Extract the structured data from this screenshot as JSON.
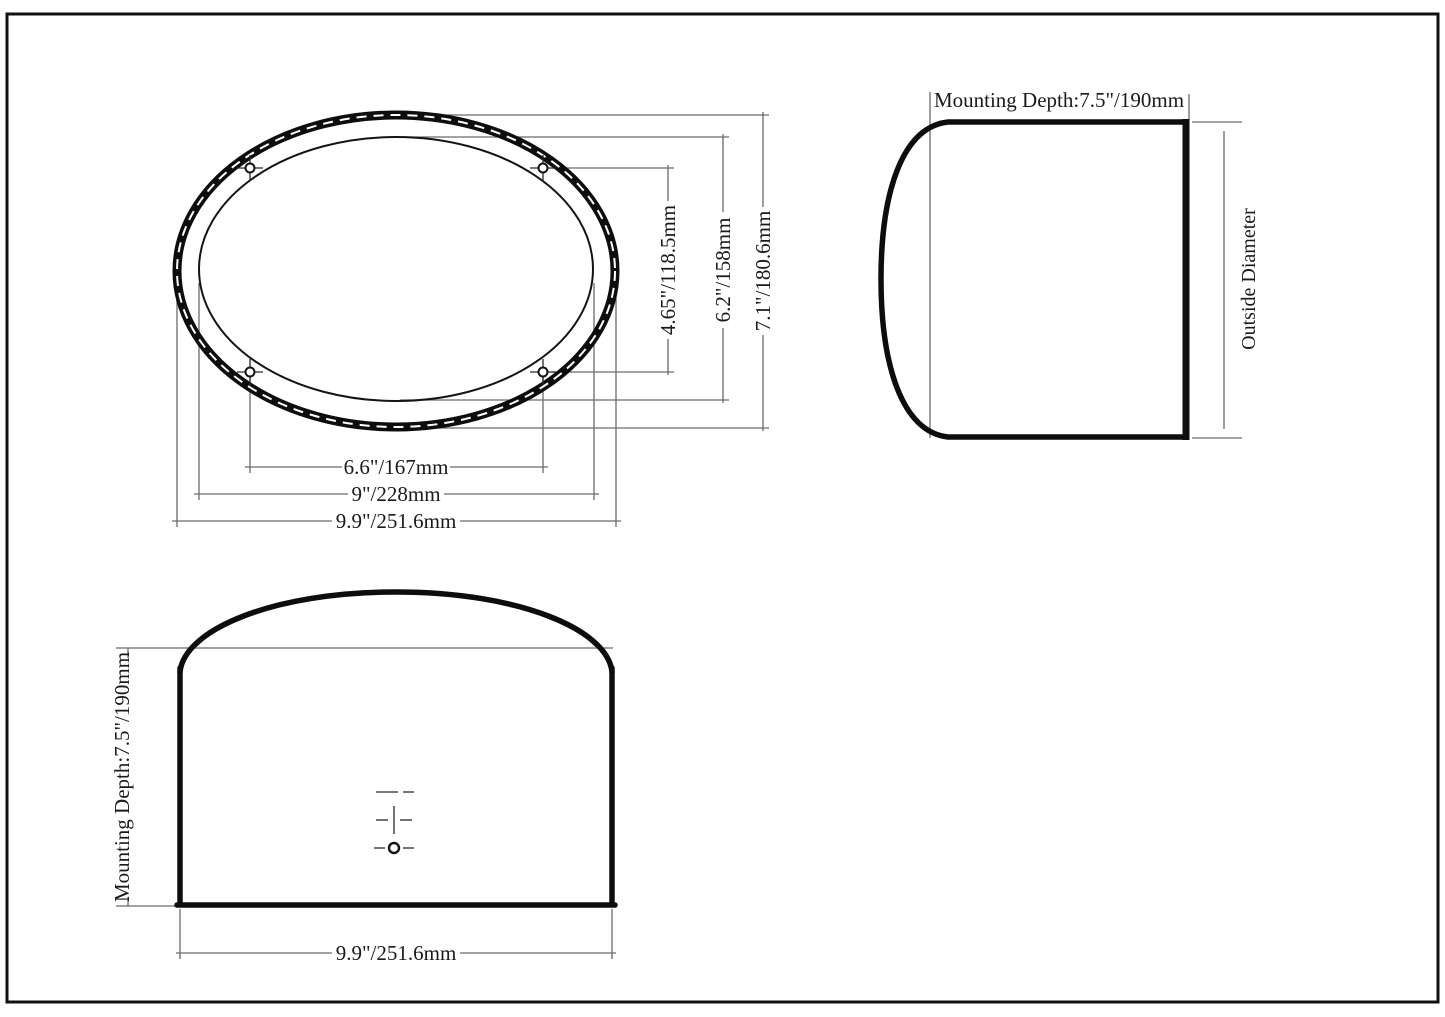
{
  "views": {
    "front": {
      "hole_spacing_width": "6.6\"/167mm",
      "cutout_width": "9\"/228mm",
      "overall_width": "9.9\"/251.6mm",
      "hole_spacing_height": "4.65\"/118.5mm",
      "cutout_height": "6.2\"/158mm",
      "overall_height": "7.1\"/180.6mm"
    },
    "side": {
      "mounting_depth": "Mounting Depth:7.5\"/190mm",
      "outside_diameter": "Outside Diameter"
    },
    "top": {
      "mounting_depth": "Mounting Depth:7.5\"/190mm",
      "overall_width": "9.9\"/251.6mm"
    }
  },
  "colors": {
    "outline": "#0d0d0d",
    "dimension_line": "#6b6b6b",
    "text": "#1a1a1a",
    "background": "#ffffff"
  }
}
